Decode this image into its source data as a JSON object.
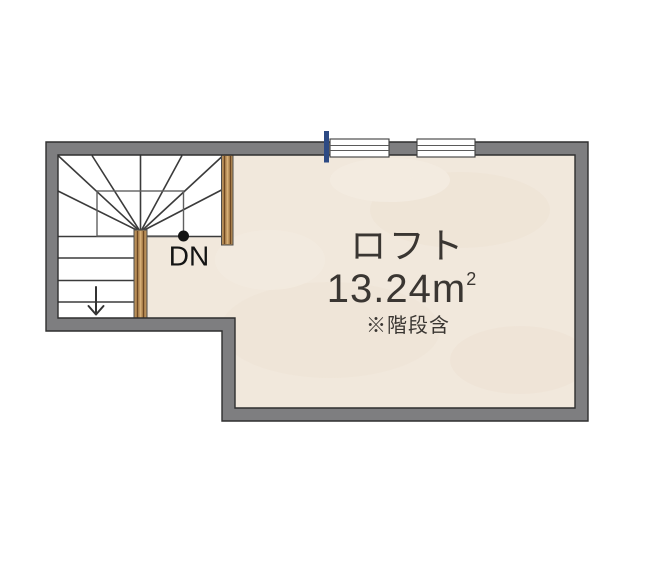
{
  "floor_plan": {
    "room": {
      "name": "ロフト",
      "area_value": "13.24m",
      "area_superscript": "2",
      "note": "※階段含"
    },
    "stairs": {
      "direction_label": "DN"
    },
    "colors": {
      "wall": "#7e7e80",
      "wall_outline": "#2f2f2f",
      "floor": "#f1e8dc",
      "floor_patch": "#e5d3bf",
      "stair_area": "#ffffff",
      "stair_line": "#3b3b3b",
      "wood": "#b88e58",
      "wood_grain": "#6d4722",
      "window_fill": "#ffffff",
      "window_marker_blue": "#2d4a84",
      "text": "#3a3632",
      "dn_text": "#141414"
    }
  }
}
